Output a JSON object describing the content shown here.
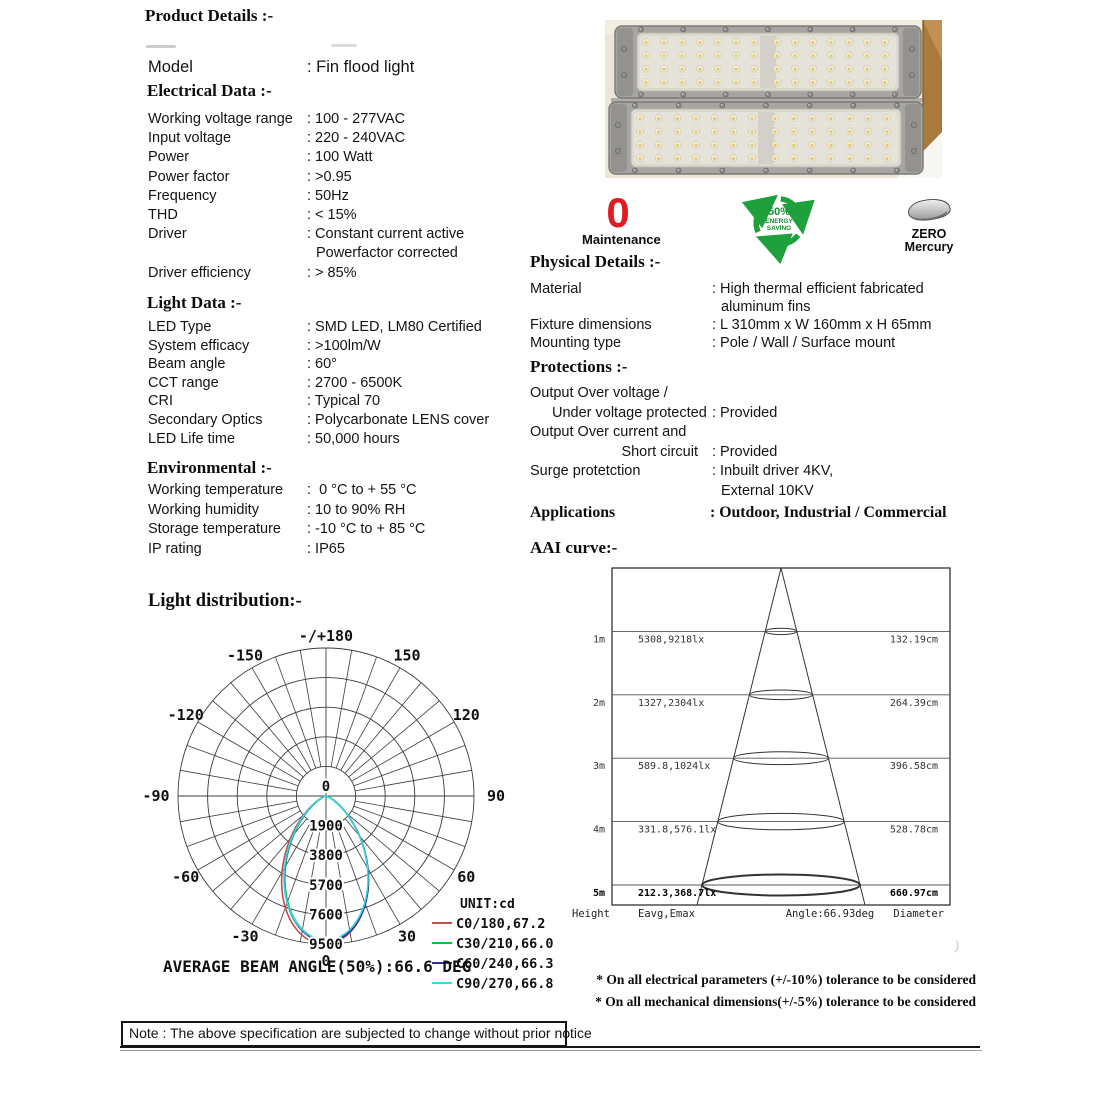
{
  "headings": {
    "product_details": "Product Details :-",
    "electrical": "Electrical Data :-",
    "light": "Light Data :-",
    "environmental": "Environmental :-",
    "physical": "Physical Details :-",
    "protections": "Protections :-"
  },
  "model": {
    "rows": [
      {
        "label": "Model",
        "value": ": Fin flood light"
      }
    ]
  },
  "sections": {
    "electrical": {
      "rows": [
        {
          "label": "Working voltage range",
          "value": ": 100 - 277VAC"
        },
        {
          "label": "Input voltage",
          "value": ": 220 - 240VAC"
        },
        {
          "label": "Power",
          "value": ": 100 Watt"
        },
        {
          "label": "Power factor",
          "value": ": >0.95"
        },
        {
          "label": "Frequency",
          "value": ": 50Hz"
        },
        {
          "label": "THD",
          "value": ": < 15%"
        },
        {
          "label": "Driver",
          "value": ": Constant current active",
          "value2": "Powerfactor corrected"
        },
        {
          "label": "Driver efficiency",
          "value": ": > 85%"
        }
      ]
    },
    "light": {
      "rows": [
        {
          "label": "LED Type",
          "value": ": SMD LED, LM80 Certified"
        },
        {
          "label": "System efficacy",
          "value": ": >100lm/W"
        },
        {
          "label": "Beam angle",
          "value": ": 60°"
        },
        {
          "label": "CCT range",
          "value": ": 2700 - 6500K"
        },
        {
          "label": "CRI",
          "value": ": Typical 70"
        },
        {
          "label": "Secondary Optics",
          "value": ": Polycarbonate LENS cover"
        },
        {
          "label": "LED Life time",
          "value": ": 50,000 hours"
        }
      ]
    },
    "environmental": {
      "rows": [
        {
          "label": "Working temperature",
          "value": ":  0 °C to + 55 °C"
        },
        {
          "label": "Working humidity",
          "value": ": 10 to 90% RH"
        },
        {
          "label": "Storage temperature",
          "value": ": -10 °C to + 85 °C"
        },
        {
          "label": "IP rating",
          "value": ": IP65"
        }
      ]
    },
    "physical": {
      "rows": [
        {
          "label": "Material",
          "value": ": High thermal efficient fabricated",
          "value2": "aluminum fins"
        },
        {
          "label": "Fixture dimensions",
          "value": ": L 310mm x W 160mm x H 65mm"
        },
        {
          "label": "Mounting type",
          "value": ": Pole / Wall / Surface mount"
        }
      ]
    },
    "protections": {
      "rows": [
        {
          "label": "Output Over voltage /",
          "value": ""
        },
        {
          "label": "Under voltage protected",
          "value": ": Provided",
          "indent": true
        },
        {
          "label": "Output Over current and",
          "value": ""
        },
        {
          "label": "Short circuit",
          "value": ": Provided",
          "align_right": true
        },
        {
          "label": "Surge protetction",
          "value": ": Inbuilt driver 4KV,",
          "value2": "External 10KV"
        }
      ]
    },
    "applications": {
      "label": "Applications",
      "value": ": Outdoor, Industrial / Commercial"
    }
  },
  "badges": {
    "maintenance": {
      "value": "0",
      "label": "Maintenance",
      "color": "#e11b22"
    },
    "energy_saving": {
      "percent": "50%",
      "line2": "ENERGY",
      "line3": "SAVING",
      "color": "#1ea03c"
    },
    "zero_mercury": {
      "line1": "ZERO",
      "line2": "Mercury"
    }
  },
  "chart_data": [
    {
      "type": "line",
      "subtype": "polar-intensity-distribution",
      "title": "Light distribution:-",
      "unit": "UNIT:cd",
      "caption": "AVERAGE BEAM ANGLE(50%):66.6 DEG",
      "center_label": "0",
      "radial_ticks": [
        1900,
        3800,
        5700,
        7600,
        9500
      ],
      "rmax": 9500,
      "angle_labels": [
        {
          "angle": 180,
          "label": "-/+180"
        },
        {
          "angle": -150,
          "label": "-150"
        },
        {
          "angle": 150,
          "label": "150"
        },
        {
          "angle": -120,
          "label": "-120"
        },
        {
          "angle": 120,
          "label": "120"
        },
        {
          "angle": -90,
          "label": "-90"
        },
        {
          "angle": 90,
          "label": "90"
        },
        {
          "angle": -60,
          "label": "-60"
        },
        {
          "angle": 60,
          "label": "60"
        },
        {
          "angle": -30,
          "label": "-30"
        },
        {
          "angle": 30,
          "label": "30"
        },
        {
          "angle": 0,
          "label": "0"
        }
      ],
      "series": [
        {
          "name": "C0/180,67.2",
          "plane": "C0/180",
          "beam_angle_deg": 67.2,
          "peak_cd": 9500,
          "color": "#c0504d",
          "asym": -0.05
        },
        {
          "name": "C30/210,66.0",
          "plane": "C30/210",
          "beam_angle_deg": 66.0,
          "peak_cd": 9300,
          "color": "#00c53c",
          "asym": 0.03
        },
        {
          "name": "C60/240,66.3",
          "plane": "C60/240",
          "beam_angle_deg": 66.3,
          "peak_cd": 9350,
          "color": "#2e3192",
          "asym": 0.02
        },
        {
          "name": "C90/270,66.8",
          "plane": "C90/270",
          "beam_angle_deg": 66.8,
          "peak_cd": 9250,
          "color": "#35d9e2",
          "asym": 0
        }
      ]
    },
    {
      "type": "table",
      "subtype": "aai-cone-diagram",
      "title": "AAI curve:-",
      "angle_text": "Angle:66.93deg",
      "footer": [
        "Height",
        "Eavg,Emax",
        "Angle:66.93deg",
        "Diameter"
      ],
      "rows": [
        {
          "height": "1m",
          "eavg_emax": "5308,9218lx",
          "diameter": "132.19cm",
          "bold": false
        },
        {
          "height": "2m",
          "eavg_emax": "1327,2304lx",
          "diameter": "264.39cm",
          "bold": false
        },
        {
          "height": "3m",
          "eavg_emax": "589.8,1024lx",
          "diameter": "396.58cm",
          "bold": false
        },
        {
          "height": "4m",
          "eavg_emax": "331.8,576.1lx",
          "diameter": "528.78cm",
          "bold": false
        },
        {
          "height": "5m",
          "eavg_emax": "212.3,368.7lx",
          "diameter": "660.97cm",
          "bold": true
        }
      ]
    }
  ],
  "footnotes": [
    "* On all electrical parameters (+/-10%) tolerance to be considered",
    "* On all mechanical dimensions(+/-5%) tolerance to be considered"
  ],
  "note": "Note : The above specification are subjected to change without prior notice"
}
